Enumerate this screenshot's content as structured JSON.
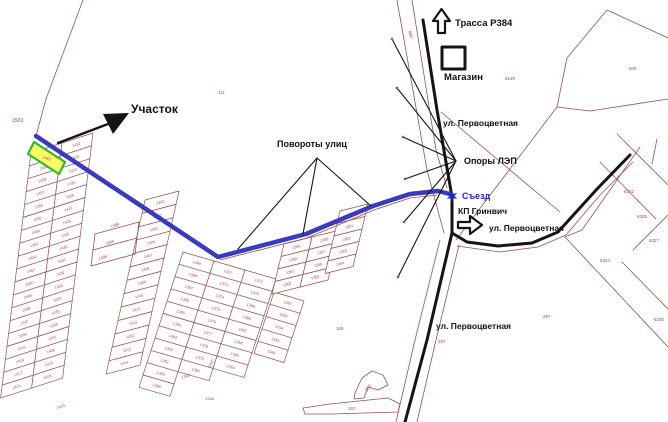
{
  "canvas": {
    "width": 668,
    "height": 422,
    "background": "#ffffff"
  },
  "palette": {
    "parcel_line": "#9b4f4f",
    "parcel_text": "#a04848",
    "route_blue": "#3a3ac0",
    "road_black": "#141414",
    "highlight_fill": "#fdfd66",
    "highlight_stroke": "#2db82d",
    "callout_black": "#111111",
    "callout_blue": "#2222cc"
  },
  "annotations": {
    "plot": "Участок",
    "street_turns": "Повороты улиц",
    "highway": "Трасса Р384",
    "shop": "Магазин",
    "street_pervotsvetnaya_top": "ул. Первоцветная",
    "power_poles": "Опоры ЛЭП",
    "exit": "Съезд",
    "kp_greenwich": "КП Гринвич",
    "street_pervotsvetnaya_mid": "ул. Первоцветная",
    "street_pervotsvetnaya_bottom": "ул. Первоцветная"
  },
  "map": {
    "routes": [
      {
        "name": "access-route",
        "width": 4.5,
        "points": [
          [
            36,
            136
          ],
          [
            218,
            257
          ],
          [
            306,
            234
          ],
          [
            373,
            206
          ],
          [
            410,
            194
          ],
          [
            438,
            191
          ],
          [
            450,
            194
          ]
        ]
      }
    ],
    "roads": [
      {
        "name": "main-road",
        "width": 3,
        "points": [
          [
            423,
            20
          ],
          [
            437,
            110
          ],
          [
            447,
            168
          ],
          [
            452,
            197
          ],
          [
            452,
            233
          ],
          [
            427,
            340
          ],
          [
            405,
            422
          ]
        ]
      },
      {
        "name": "pervotsvetnaya-curve",
        "width": 3,
        "points": [
          [
            452,
            233
          ],
          [
            467,
            242
          ],
          [
            498,
            246
          ],
          [
            532,
            243
          ],
          [
            558,
            232
          ],
          [
            597,
            189
          ],
          [
            630,
            155
          ]
        ]
      }
    ],
    "parcel_lines": [
      {
        "points": [
          [
            83,
            0
          ],
          [
            46,
            99
          ],
          [
            36,
            136
          ]
        ]
      },
      {
        "points": [
          [
            668,
            38
          ],
          [
            607,
            10
          ],
          [
            567,
            58
          ],
          [
            557,
            107
          ],
          [
            590,
            111
          ],
          [
            668,
            99
          ]
        ]
      },
      {
        "points": [
          [
            397,
            0
          ],
          [
            427,
            170
          ],
          [
            444,
            233
          ]
        ]
      },
      {
        "points": [
          [
            412,
            0
          ],
          [
            436,
            150
          ],
          [
            447,
            188
          ]
        ]
      },
      {
        "points": [
          [
            440,
            240
          ],
          [
            415,
            340
          ],
          [
            396,
            422
          ]
        ]
      },
      {
        "points": [
          [
            459,
            245
          ],
          [
            436,
            340
          ],
          [
            417,
            422
          ]
        ]
      },
      {
        "points": [
          [
            457,
            246
          ],
          [
            500,
            252
          ],
          [
            538,
            247
          ],
          [
            566,
            235
          ],
          [
            600,
            195
          ],
          [
            633,
            162
          ]
        ]
      },
      {
        "points": [
          [
            441,
            112
          ],
          [
            560,
            212
          ]
        ]
      },
      {
        "points": [
          [
            557,
            107
          ],
          [
            456,
            240
          ]
        ]
      },
      {
        "points": [
          [
            220,
            260
          ],
          [
            307,
            238
          ],
          [
            374,
            210
          ],
          [
            410,
            198
          ],
          [
            437,
            195
          ]
        ]
      },
      {
        "points": [
          [
            640,
            147
          ],
          [
            582,
            230
          ]
        ]
      },
      {
        "points": [
          [
            617,
            134
          ],
          [
            668,
            185
          ]
        ]
      },
      {
        "points": [
          [
            600,
            162
          ],
          [
            656,
            219
          ]
        ]
      },
      {
        "points": [
          [
            565,
            237
          ],
          [
            668,
            347
          ]
        ]
      },
      {
        "points": [
          [
            582,
            230
          ],
          [
            565,
            237
          ]
        ]
      },
      {
        "points": [
          [
            633,
            250
          ],
          [
            668,
            215
          ]
        ]
      },
      {
        "points": [
          [
            622,
            262
          ],
          [
            668,
            309
          ]
        ]
      },
      {
        "points": [
          [
            657,
            139
          ],
          [
            652,
            164
          ]
        ]
      },
      {
        "points": [
          [
            95,
            234
          ],
          [
            139,
            222
          ]
        ]
      },
      {
        "points": [
          [
            93,
            250
          ],
          [
            137,
            238
          ]
        ]
      },
      {
        "points": [
          [
            91,
            266
          ],
          [
            135,
            254
          ]
        ]
      },
      {
        "points": [
          [
            95,
            234
          ],
          [
            91,
            266
          ]
        ]
      },
      {
        "points": [
          [
            139,
            222
          ],
          [
            135,
            254
          ]
        ]
      }
    ],
    "parcel_polygons": [
      {
        "points": [
          [
            355,
            393
          ],
          [
            362,
            378
          ],
          [
            372,
            371
          ],
          [
            383,
            375
          ],
          [
            388,
            385
          ],
          [
            378,
            390
          ],
          [
            368,
            387
          ],
          [
            364,
            398
          ],
          [
            354,
            399
          ]
        ]
      },
      {
        "points": [
          [
            303,
            408
          ],
          [
            330,
            404
          ],
          [
            388,
            398
          ],
          [
            400,
            404
          ],
          [
            398,
            412
          ],
          [
            332,
            414
          ],
          [
            305,
            414
          ]
        ]
      }
    ],
    "highlight_plot": {
      "points": [
        [
          34,
          142
        ],
        [
          65,
          162
        ],
        [
          59,
          174
        ],
        [
          28,
          154
        ]
      ],
      "number": "1461"
    },
    "pole_dots": [
      [
        392,
        39
      ],
      [
        397,
        88
      ],
      [
        403,
        137
      ],
      [
        405,
        179
      ],
      [
        404,
        222
      ],
      [
        398,
        277
      ]
    ],
    "fans": [
      {
        "name": "power-poles-fan",
        "apex": [
          456,
          161
        ],
        "targets": [
          [
            392,
            39
          ],
          [
            397,
            88
          ],
          [
            403,
            137
          ],
          [
            405,
            179
          ],
          [
            404,
            222
          ],
          [
            398,
            277
          ]
        ]
      },
      {
        "name": "street-turns-fan",
        "apex": [
          317,
          158
        ],
        "targets": [
          [
            238,
            249
          ],
          [
            303,
            234
          ],
          [
            371,
            206
          ]
        ]
      }
    ],
    "plot_arrow": {
      "line": [
        [
          58,
          143
        ],
        [
          108,
          124
        ]
      ],
      "head": [
        [
          129,
          113
        ],
        [
          103,
          114
        ],
        [
          113,
          134
        ]
      ]
    },
    "icons": {
      "highway_up_arrow": [
        [
          438,
          33
        ],
        [
          438,
          21
        ],
        [
          433,
          21
        ],
        [
          441.5,
          9
        ],
        [
          450,
          21
        ],
        [
          445,
          21
        ],
        [
          445,
          33
        ]
      ],
      "entrance_right_arrow": [
        [
          458,
          222
        ],
        [
          470,
          222
        ],
        [
          470,
          216
        ],
        [
          482,
          225
        ],
        [
          470,
          234
        ],
        [
          470,
          228
        ],
        [
          458,
          228
        ]
      ],
      "shop_square": [
        [
          442,
          47
        ],
        [
          465,
          47
        ],
        [
          465,
          69
        ],
        [
          442,
          69
        ]
      ]
    },
    "exit_star": {
      "cx": 452,
      "cy": 196,
      "r": 6
    },
    "plot_numbers": [
      {
        "t": "1503",
        "x": 12,
        "y": 122,
        "s": 5
      },
      {
        "t": "111",
        "x": 218,
        "y": 94,
        "s": 4.5
      },
      {
        "t": "480",
        "x": 408,
        "y": 31,
        "s": 4.5,
        "r": 72
      },
      {
        "t": "5130",
        "x": 505,
        "y": 80,
        "s": 4.5
      },
      {
        "t": "605",
        "x": 629,
        "y": 70,
        "s": 4.5
      },
      {
        "t": "6322",
        "x": 624,
        "y": 193,
        "s": 4.5
      },
      {
        "t": "6325",
        "x": 637,
        "y": 218,
        "s": 4.5
      },
      {
        "t": "6327",
        "x": 649,
        "y": 242,
        "s": 4.5
      },
      {
        "t": "6324",
        "x": 600,
        "y": 262,
        "s": 4.5
      },
      {
        "t": "6330",
        "x": 654,
        "y": 321,
        "s": 4.5
      },
      {
        "t": "297",
        "x": 543,
        "y": 318,
        "s": 4.5
      },
      {
        "t": "297",
        "x": 438,
        "y": 343,
        "s": 4.5
      },
      {
        "t": "165",
        "x": 336,
        "y": 330,
        "s": 4.5
      },
      {
        "t": "163",
        "x": 367,
        "y": 392,
        "s": 4.5,
        "r": -55
      },
      {
        "t": "167",
        "x": 348,
        "y": 410,
        "s": 4.5
      },
      {
        "t": "1405",
        "x": 106,
        "y": 245,
        "s": 4,
        "r": -18
      },
      {
        "t": "1406",
        "x": 99,
        "y": 260,
        "s": 4,
        "r": -18
      },
      {
        "t": "1388",
        "x": 111,
        "y": 228,
        "s": 4,
        "r": -18
      },
      {
        "t": "1348",
        "x": 205,
        "y": 400,
        "s": 4
      },
      {
        "t": "1349",
        "x": 182,
        "y": 379,
        "s": 4,
        "r": -20
      },
      {
        "t": "1347",
        "x": 210,
        "y": 368,
        "s": 4,
        "r": -60
      },
      {
        "t": "1415",
        "x": 57,
        "y": 409,
        "s": 4,
        "r": -15
      }
    ],
    "ladders": [
      {
        "o": [
          31,
          153
        ],
        "wv": [
          31,
          -10
        ],
        "hv": [
          -1.6,
          12.9
        ],
        "nums": [
          1460,
          1459,
          1458,
          1457,
          1456,
          1455,
          1454,
          1453,
          1452,
          1451,
          1450,
          1449,
          1448,
          1447,
          1446,
          1419,
          1418,
          1417,
          1416
        ]
      },
      {
        "o": [
          62,
          143
        ],
        "wv": [
          31,
          -10
        ],
        "hv": [
          -1.6,
          12.9
        ],
        "nums": [
          1422,
          1423,
          1424,
          1425,
          1426,
          1427,
          1428,
          1429,
          1430,
          1431,
          1432,
          1433,
          1434,
          1435,
          1436,
          1437,
          1438,
          1414,
          1415
        ]
      },
      {
        "o": [
          145,
          200
        ],
        "wv": [
          34,
          -9
        ],
        "hv": [
          -3,
          13.4
        ],
        "nums": [
          1403,
          1402,
          1401,
          1400,
          1407,
          1408,
          1409,
          1410,
          1411,
          1412,
          1452,
          1413,
          1414
        ]
      },
      {
        "o": [
          183,
          252
        ],
        "wv": [
          31,
          9
        ],
        "hv": [
          -4,
          12.3
        ],
        "nums": [
          1399,
          1398,
          1397,
          1396,
          1395,
          1394,
          1393,
          1392,
          1391,
          1390,
          1389
        ]
      },
      {
        "o": [
          214,
          261
        ],
        "wv": [
          31,
          9
        ],
        "hv": [
          -4,
          12.3
        ],
        "nums": [
          1372,
          1373,
          1374,
          1375,
          1376,
          1377,
          1378,
          1379,
          1380
        ]
      },
      {
        "o": [
          245,
          270
        ],
        "wv": [
          31,
          9
        ],
        "hv": [
          -4,
          12.3
        ],
        "nums": [
          1371,
          1370,
          1369,
          1368,
          1367,
          1366,
          1365,
          1364
        ]
      },
      {
        "o": [
          274,
          292
        ],
        "wv": [
          30,
          9
        ],
        "hv": [
          -4,
          12.3
        ],
        "nums": [
          1342,
          1343,
          1344,
          1345,
          1346
        ]
      },
      {
        "o": [
          284,
          244
        ],
        "wv": [
          28,
          -7
        ],
        "hv": [
          -3,
          12.5
        ],
        "nums": [
          1359,
          1360,
          1361,
          1362
        ]
      },
      {
        "o": [
          312,
          237
        ],
        "wv": [
          28,
          -7
        ],
        "hv": [
          -3,
          12.5
        ],
        "nums": [
          1358,
          1357,
          1356,
          1355
        ]
      },
      {
        "o": [
          340,
          211
        ],
        "wv": [
          28,
          -7
        ],
        "hv": [
          -3,
          12.5
        ],
        "nums": [
          1350,
          1351,
          1352,
          1353,
          1354
        ]
      }
    ]
  }
}
